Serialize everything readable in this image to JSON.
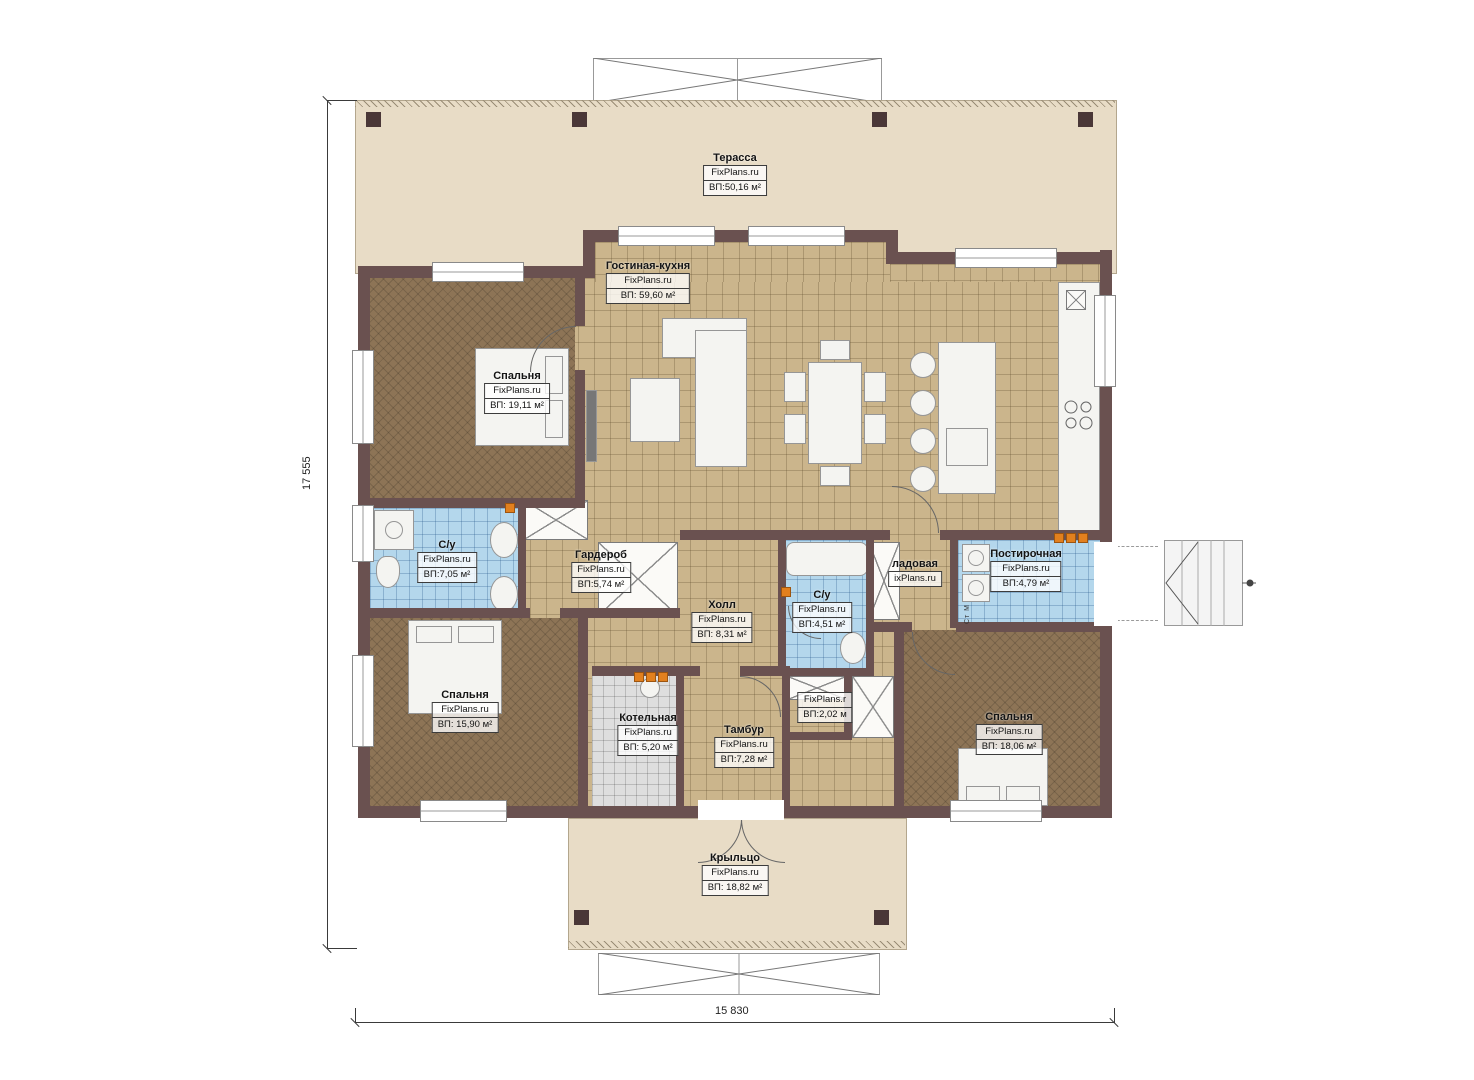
{
  "watermark": "FixPlans.ru",
  "rooms": [
    {
      "name": "Терасса",
      "watermark": "FixPlans.ru",
      "area": "ВП:50,16 м²"
    },
    {
      "name": "Гостиная-кухня",
      "watermark": "FixPlans.ru",
      "area": "ВП: 59,60 м²"
    },
    {
      "name": "Спальня",
      "watermark": "FixPlans.ru",
      "area": "ВП: 19,11 м²"
    },
    {
      "name": "С/у",
      "watermark": "FixPlans.ru",
      "area": "ВП:7,05 м²"
    },
    {
      "name": "Гардероб",
      "watermark": "FixPlans.ru",
      "area": "ВП:5,74 м²"
    },
    {
      "name": "Холл",
      "watermark": "FixPlans.ru",
      "area": "ВП: 8,31 м²"
    },
    {
      "name": "С/у",
      "watermark": "FixPlans.ru",
      "area": "ВП:4,51 м²"
    },
    {
      "name": "ладовая",
      "watermark": "ixPlans.ru",
      "area": null
    },
    {
      "name": "Постирочная",
      "watermark": "FixPlans.ru",
      "area": "ВП:4,79 м²"
    },
    {
      "name": "Спальня",
      "watermark": "FixPlans.ru",
      "area": "ВП: 15,90 м²"
    },
    {
      "name": "Котельная",
      "watermark": "FixPlans.ru",
      "area": "ВП: 5,20 м²"
    },
    {
      "name": "Тамбур",
      "watermark": "FixPlans.ru",
      "area": "ВП:7,28 м²"
    },
    {
      "name": null,
      "watermark": "FixPlans.r",
      "area": "ВП:2,02 м"
    },
    {
      "name": "Спальня",
      "watermark": "FixPlans.ru",
      "area": "ВП: 18,06 м²"
    },
    {
      "name": "Крыльцо",
      "watermark": "FixPlans.ru",
      "area": "ВП: 18,82 м²"
    }
  ],
  "dimensions": {
    "height": "17 555",
    "width": "15 830"
  },
  "labels": {
    "appliance": "Ст М"
  },
  "colors": {
    "wall": "#6a5150",
    "floor_tan": "#cbb58c",
    "floor_brown": "#8d7456",
    "tile_blue": "#b4d7ec",
    "tile_gray": "#dedede",
    "deck": "#e8dcc6",
    "marker_orange": "#e2801e"
  }
}
